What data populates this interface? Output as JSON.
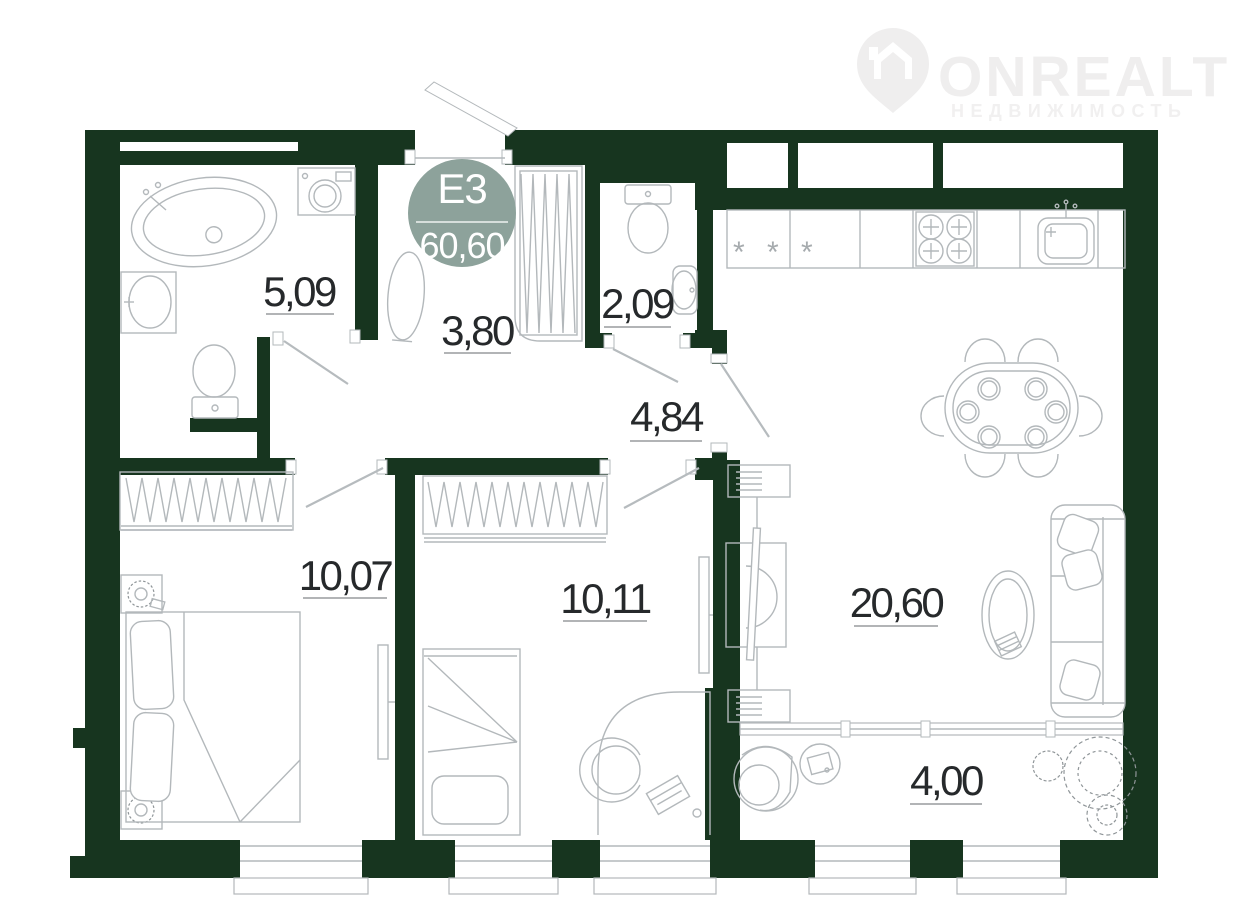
{
  "logo": {
    "name": "ONREALT",
    "subtitle": "НЕДВИЖИМОСТЬ"
  },
  "badge": {
    "unit": "Е3",
    "total_area": "60,60",
    "color": "#8da29b"
  },
  "plan": {
    "wall_color": "#17351f",
    "furniture_color": "#b3b8bb",
    "label_color": "#26292b",
    "rooms": [
      {
        "name": "bathroom",
        "area": "5,09"
      },
      {
        "name": "entry-hall",
        "area": "3,80"
      },
      {
        "name": "wc",
        "area": "2,09"
      },
      {
        "name": "corridor",
        "area": "4,84"
      },
      {
        "name": "bedroom-1",
        "area": "10,07"
      },
      {
        "name": "bedroom-2",
        "area": "10,11"
      },
      {
        "name": "living-kitchen",
        "area": "20,60"
      },
      {
        "name": "balcony",
        "area": "4,00"
      }
    ],
    "fridge_marks": "* * *"
  }
}
